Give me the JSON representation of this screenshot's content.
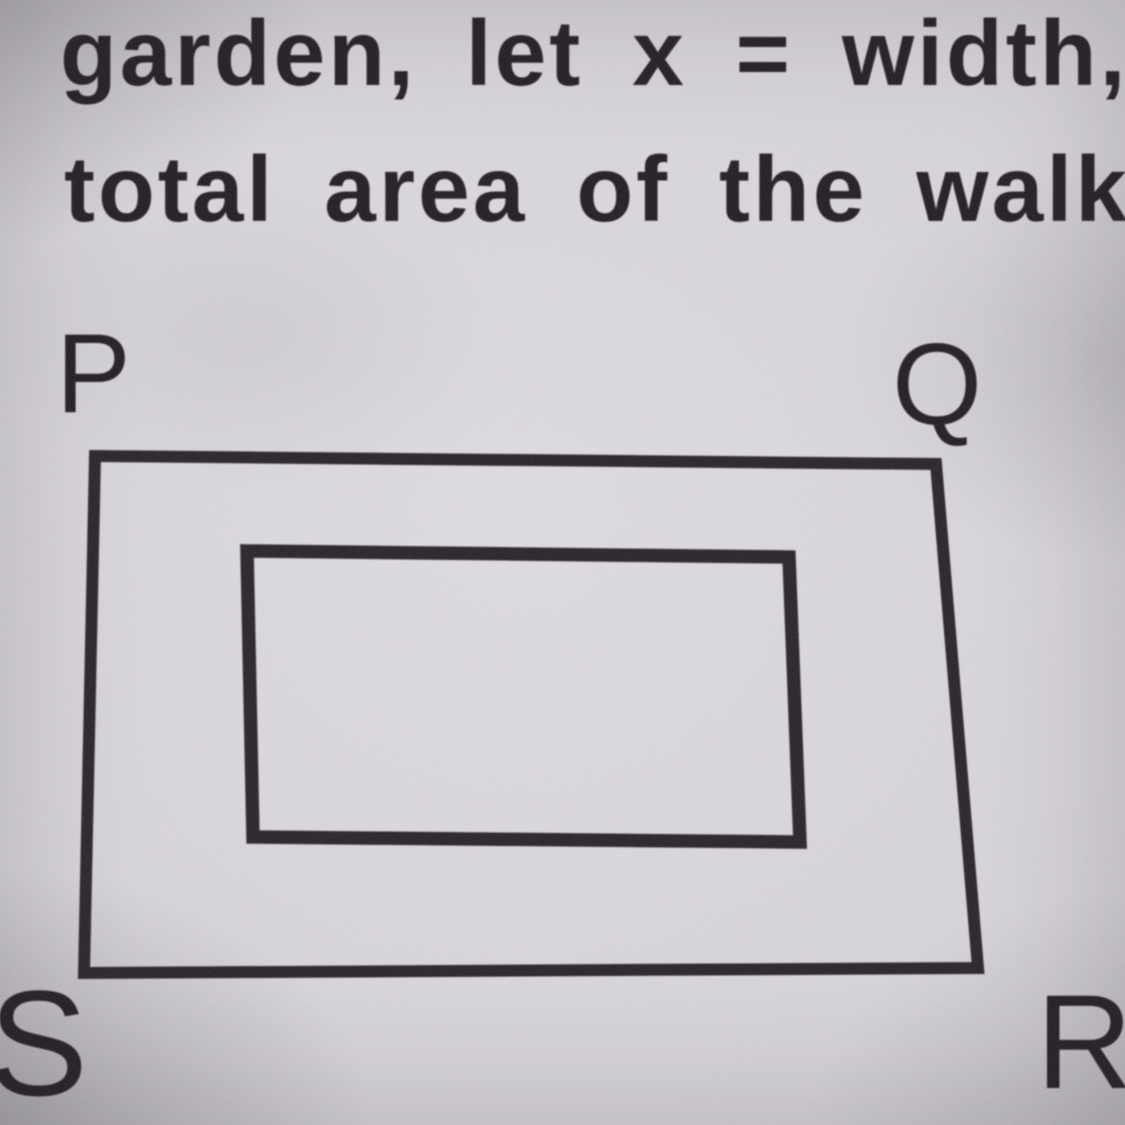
{
  "page": {
    "problem_text": {
      "line1": "garden, let x = width,",
      "line2": "total area of the walk"
    },
    "diagram": {
      "corner_labels": {
        "top_left": "P",
        "top_right": "Q",
        "bottom_right": "R",
        "bottom_left": "S"
      }
    },
    "colors": {
      "paper": "#d3d0d5",
      "ink": "#26202a"
    }
  }
}
